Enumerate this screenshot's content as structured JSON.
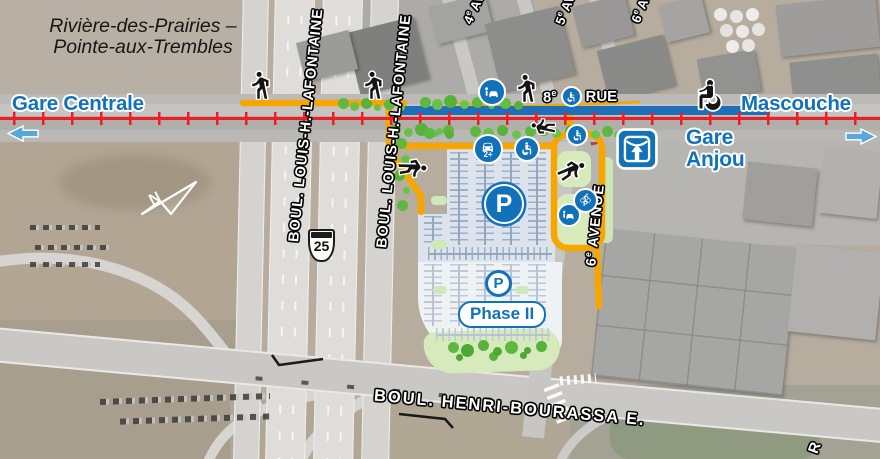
{
  "map": {
    "region_title": {
      "line1": "Rivière-des-Prairies –",
      "line2": "Pointe-aux-Trembles"
    },
    "rail_line": {
      "west_terminus": "Gare Centrale",
      "east_terminus": "Mascouche"
    },
    "station": {
      "name_line1": "Gare",
      "name_line2": "Anjou"
    },
    "north_label": "N",
    "streets": {
      "rue_8": {
        "number": "8",
        "ordinal": "e",
        "type": "RUE"
      },
      "avenue_4": {
        "number": "4",
        "ordinal": "e",
        "type": "AV."
      },
      "avenue_5": {
        "number": "5",
        "ordinal": "e",
        "type": "AV."
      },
      "avenue_6_short": {
        "number": "6",
        "ordinal": "e",
        "type": "AV."
      },
      "avenue_6_full": {
        "number": "6",
        "ordinal": "e",
        "type": "AVENUE"
      },
      "lafontaine_west": "BOUL. LOUIS-H.-LAFONTAINE",
      "lafontaine_east": "BOUL. LOUIS-H.-LAFONTAINE",
      "henri_bourassa": "BOUL. HENRI-BOURASSA E.",
      "highway_shield": "25",
      "partial_street": "R"
    },
    "parking": {
      "symbol": "P",
      "phase_label": "Phase II",
      "carpool_badge": "2+",
      "bike_parking_symbol": "P"
    },
    "icons": {
      "pedestrian": "walking-person-icon",
      "wheelchair_user": "wheelchair-person-icon",
      "kiss_and_ride": "car-dropoff-icon",
      "carpool_parking": "carpool-car-icon",
      "accessible_parking": "wheelchair-icon",
      "parking": "parking-p-icon",
      "bike_parking": "bike-parking-icon",
      "station_logo": "commuter-train-icon",
      "north_arrow": "north-arrow-icon",
      "line_direction_west": "left-arrow-icon",
      "line_direction_east": "right-arrow-icon"
    },
    "colors": {
      "brand_blue": "#1272b9",
      "rail_red": "#ee1c25",
      "path_yellow": "#f7a600",
      "bus_lane_blue": "#1d6fb8",
      "bush_green": "#5eb840",
      "island_green": "#d7eabc",
      "parking_phase1": "#dce3ec",
      "parking_phase2": "#eff2f5",
      "road_gray": "#c9c8c5",
      "terrain": "#b6ad9f"
    }
  }
}
